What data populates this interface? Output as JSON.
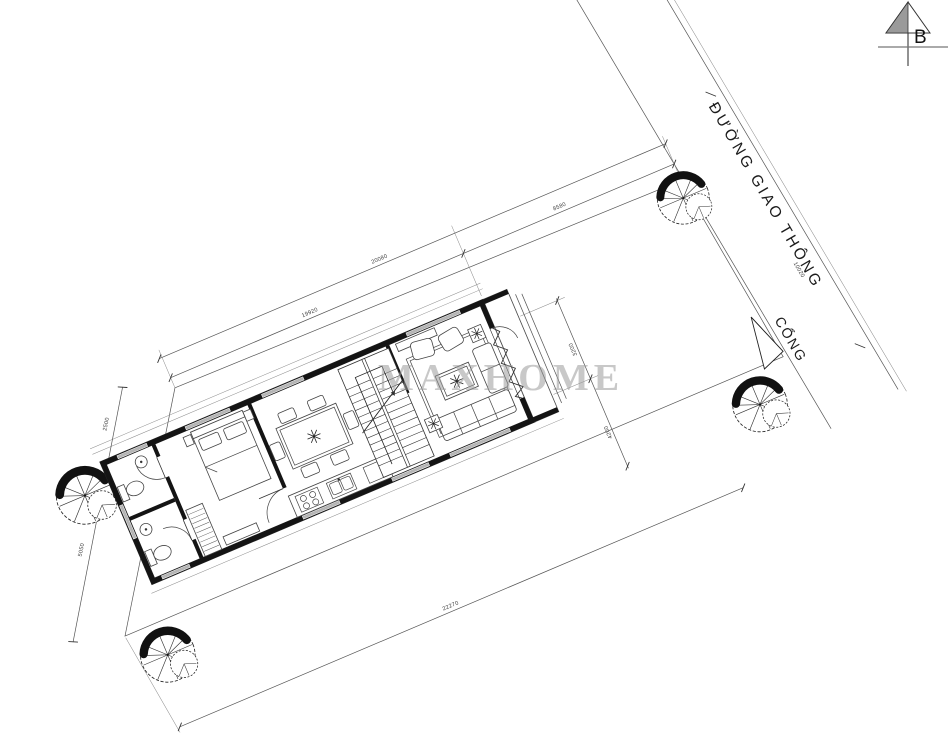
{
  "drawing": {
    "watermark": "MAXHOME",
    "compass_label": "B",
    "road_name": "ĐƯỜNG GIAO THÔNG",
    "gate_label": "CỔNG"
  },
  "dimensions": {
    "top_site_length": "20080",
    "top_building_length": "19920",
    "top_road_frontage": "8580",
    "left_upper": "2500",
    "left_lower": "5050",
    "front_upper": "3200",
    "front_lower": "4200",
    "road_width": "10020",
    "bottom_site_length": "22270"
  },
  "colors": {
    "line": "#2a2a2a",
    "wall": "#141414",
    "window": "#b5b5b5",
    "watermark": "#9c9c9c"
  }
}
